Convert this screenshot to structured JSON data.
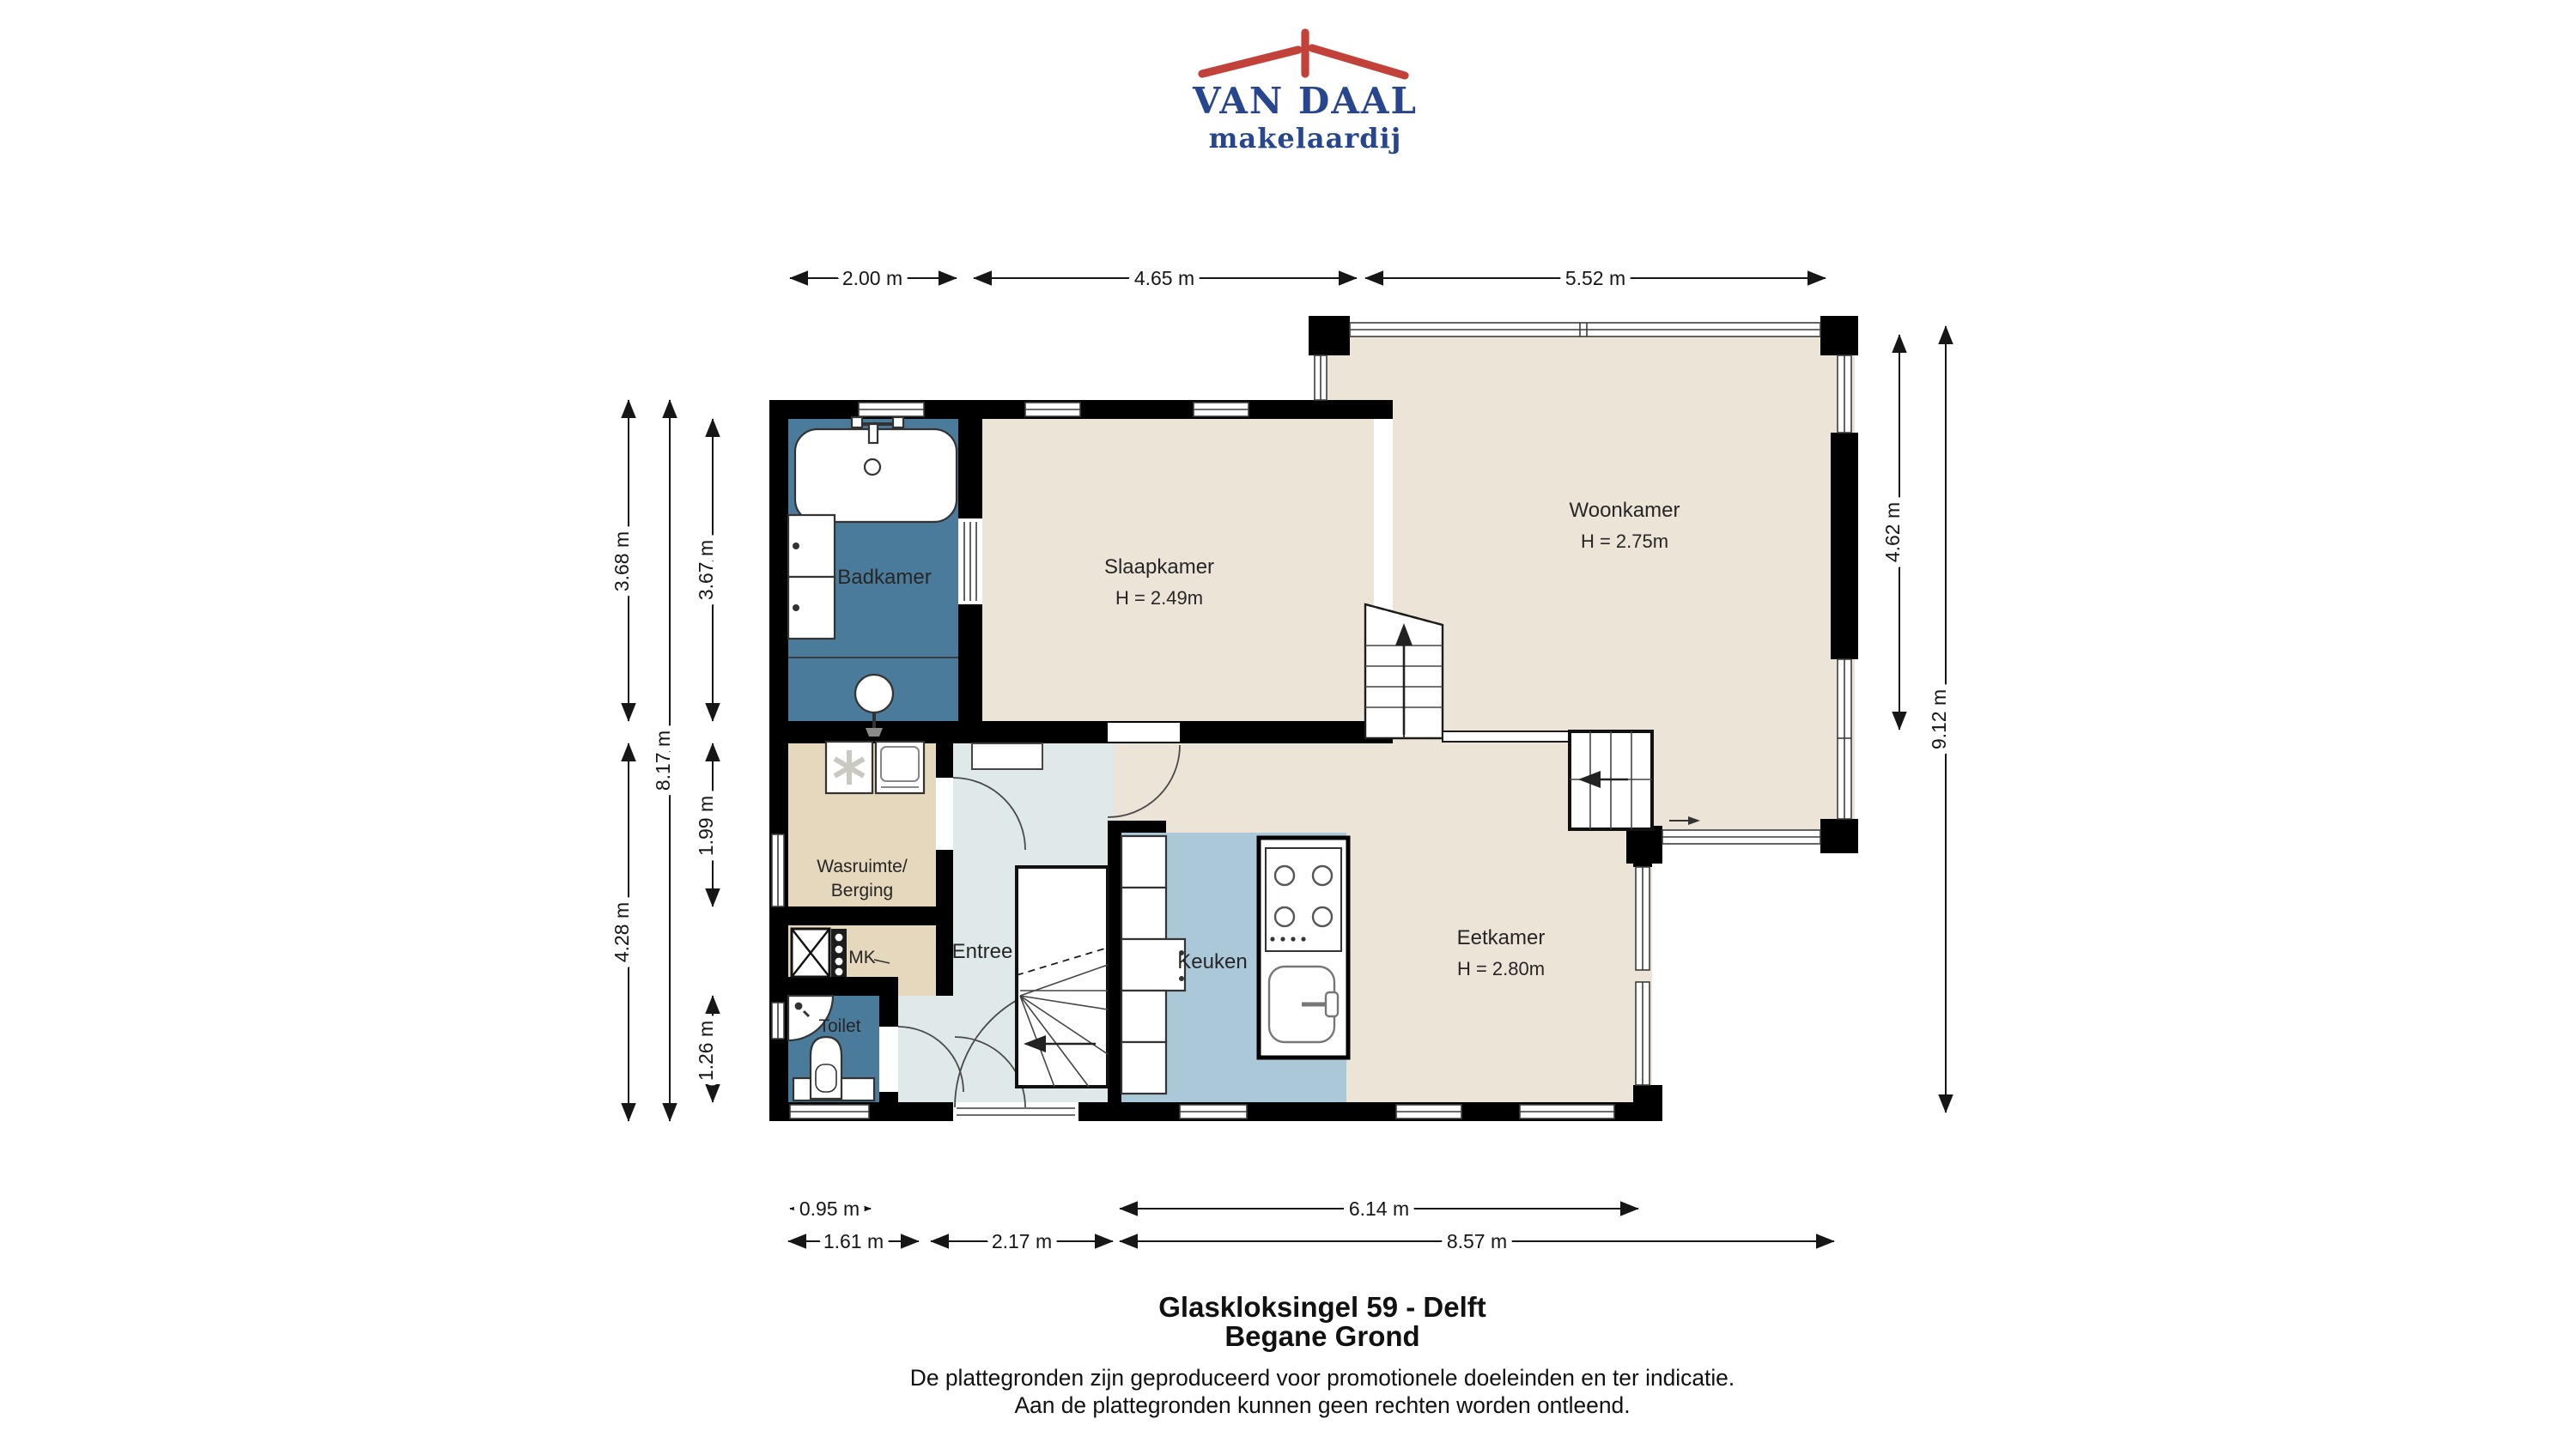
{
  "logo": {
    "brand": "VAN DAAL",
    "subtitle": "makelaardij"
  },
  "rooms": {
    "badkamer": {
      "label": "Badkamer"
    },
    "slaapkamer": {
      "label": "Slaapkamer",
      "height": "H = 2.49m"
    },
    "woonkamer": {
      "label": "Woonkamer",
      "height": "H = 2.75m"
    },
    "wasruimte": {
      "label_line1": "Wasruimte/",
      "label_line2": "Berging"
    },
    "mk": {
      "label": "MK"
    },
    "entree": {
      "label": "Entree"
    },
    "toilet": {
      "label": "Toilet"
    },
    "keuken": {
      "label": "Keuken"
    },
    "eetkamer": {
      "label": "Eetkamer",
      "height": "H = 2.80m"
    }
  },
  "dimensions": {
    "top": [
      "2.00 m",
      "4.65 m",
      "5.52 m"
    ],
    "left_outer": [
      "3.68 m",
      "4.28 m"
    ],
    "left_middle": [
      "8.17 m"
    ],
    "left_inner": [
      "3.67 m",
      "1.99 m",
      "1.26 m"
    ],
    "right_inner": [
      "4.62 m"
    ],
    "right_outer": [
      "9.12 m"
    ],
    "bottom_upper": [
      "0.95 m",
      "6.14 m"
    ],
    "bottom_lower": [
      "1.61 m",
      "2.17 m",
      "8.57 m"
    ]
  },
  "footer": {
    "address": "Glaskloksingel 59 - Delft",
    "floor": "Begane Grond",
    "disclaimer1": "De plattegronden zijn geproduceerd voor promotionele doeleinden en ter indicatie.",
    "disclaimer2": "Aan de plattegronden kunnen geen rechten worden ontleend."
  },
  "colors": {
    "wall": "#000000",
    "floor_beige": "#ede4d8",
    "room_blue": "#4b7b9a",
    "room_tan": "#e5d8bd",
    "entree_gray": "#dfe9e9",
    "kitchen_blue": "#abc8d9",
    "logo_navy": "#27468e",
    "logo_red": "#c2423a"
  }
}
